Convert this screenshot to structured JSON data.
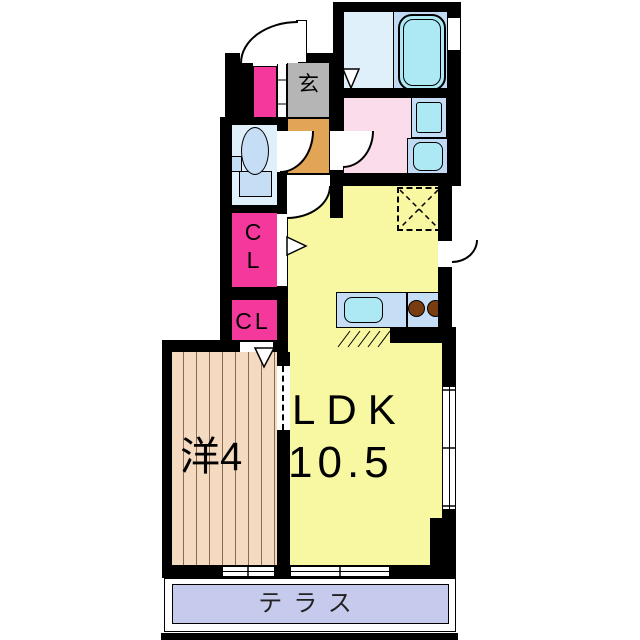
{
  "floor_plan": {
    "labels": {
      "entrance": "玄",
      "closet_upper": {
        "line1": "C",
        "line2": "L"
      },
      "closet_lower": "CL",
      "ldk_name": "LDK",
      "ldk_size": "10.5",
      "western_room": "洋4",
      "terrace": "テラス"
    },
    "colors": {
      "wall": "#000000",
      "ldk_floor": "#F8F8A2",
      "western_room_floor": "#F3DAC0",
      "closet": "#F5399C",
      "washroom": "#FADCEA",
      "bathroom": "#DFF0FA",
      "bathtub_zone": "#BFDAF2",
      "fixture_water": "#ACE9F5",
      "fixture_base": "#C6DEF5",
      "entrance_hall_floor": "#B5B5B5",
      "entrance_step_floor": "#E2A455",
      "terrace": "#C6CAEC",
      "stove_burner": "#7A3D10"
    },
    "icons": [
      "bathtub-icon",
      "folding-door-icon",
      "washing-machine-pan-icon",
      "vanity-sink-icon",
      "toilet-icon",
      "kitchen-counter-icon",
      "kitchen-sink-icon",
      "stove-burner-icon",
      "refrigerator-space-icon",
      "door-swing-icon",
      "sliding-door-icon",
      "sliding-window-icon"
    ]
  }
}
